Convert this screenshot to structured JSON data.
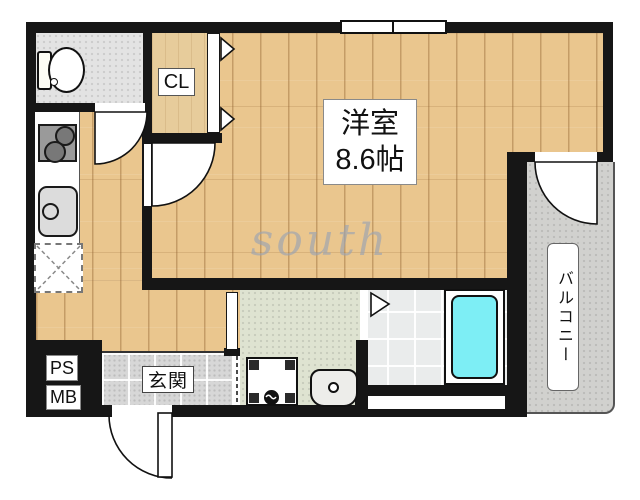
{
  "watermark": "south",
  "labels": {
    "main_room_name": "洋室",
    "main_room_size": "8.6帖",
    "closet": "CL",
    "balcony": "バルコニー",
    "entrance": "玄関",
    "pipe_space": "PS",
    "meter_box": "MB"
  },
  "fixtures": {
    "toilet": "toilet",
    "stove": "two-burner-stove",
    "kitchen_sink": "kitchen-sink",
    "refrigerator_space": "refrigerator-space",
    "washing_machine_pan": "washing-machine-pan",
    "washbasin": "washbasin",
    "bathtub": "bathtub",
    "window": "window",
    "doors": "hinged-and-folding-doors"
  },
  "colors": {
    "wall": "#161616",
    "wood_floor": "#eac68e",
    "closet_wood": "#e7cc9b",
    "toilet_floor": "#e3e3e3",
    "entrance_tile": "#d7d7d7",
    "washroom_floor": "#dee3d1",
    "bathroom_tile": "#eaecec",
    "balcony_concrete": "#d1d1ce",
    "bathtub_fill": "#7deef5",
    "watermark_gray": "#9aa3b2"
  }
}
